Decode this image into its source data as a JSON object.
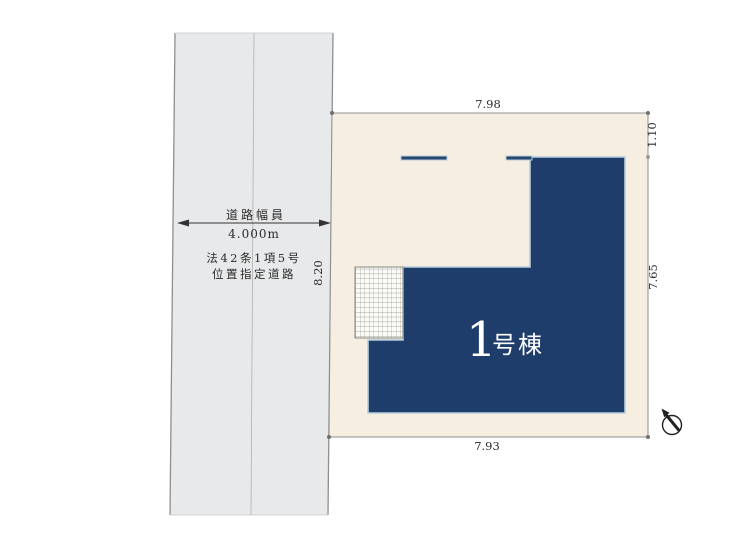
{
  "site_plan": {
    "title": "site-plan-diagram",
    "dimensions": {
      "lot_top": "7.98",
      "setback_right_upper": "1.10",
      "lot_right_lower": "7.65",
      "lot_bottom": "7.93",
      "road_frontage": "8.20"
    },
    "road": {
      "width_label": "道路幅員",
      "width_value": "4.000m",
      "law_line1": "法42条1項5号",
      "law_line2": "位置指定道路"
    },
    "building": {
      "number": "1",
      "suffix": "号棟",
      "full_label": "1号棟"
    },
    "colors": {
      "building_fill": "#1f3d6b",
      "building_halo": "#b7cddf",
      "lot_fill": "#f6efe1",
      "road_fill": "#e8e9ea",
      "line_gray": "#8f8f8f",
      "dim_text": "#2b2b2b"
    },
    "icons": {
      "compass": "north-arrow-compass-icon"
    }
  }
}
